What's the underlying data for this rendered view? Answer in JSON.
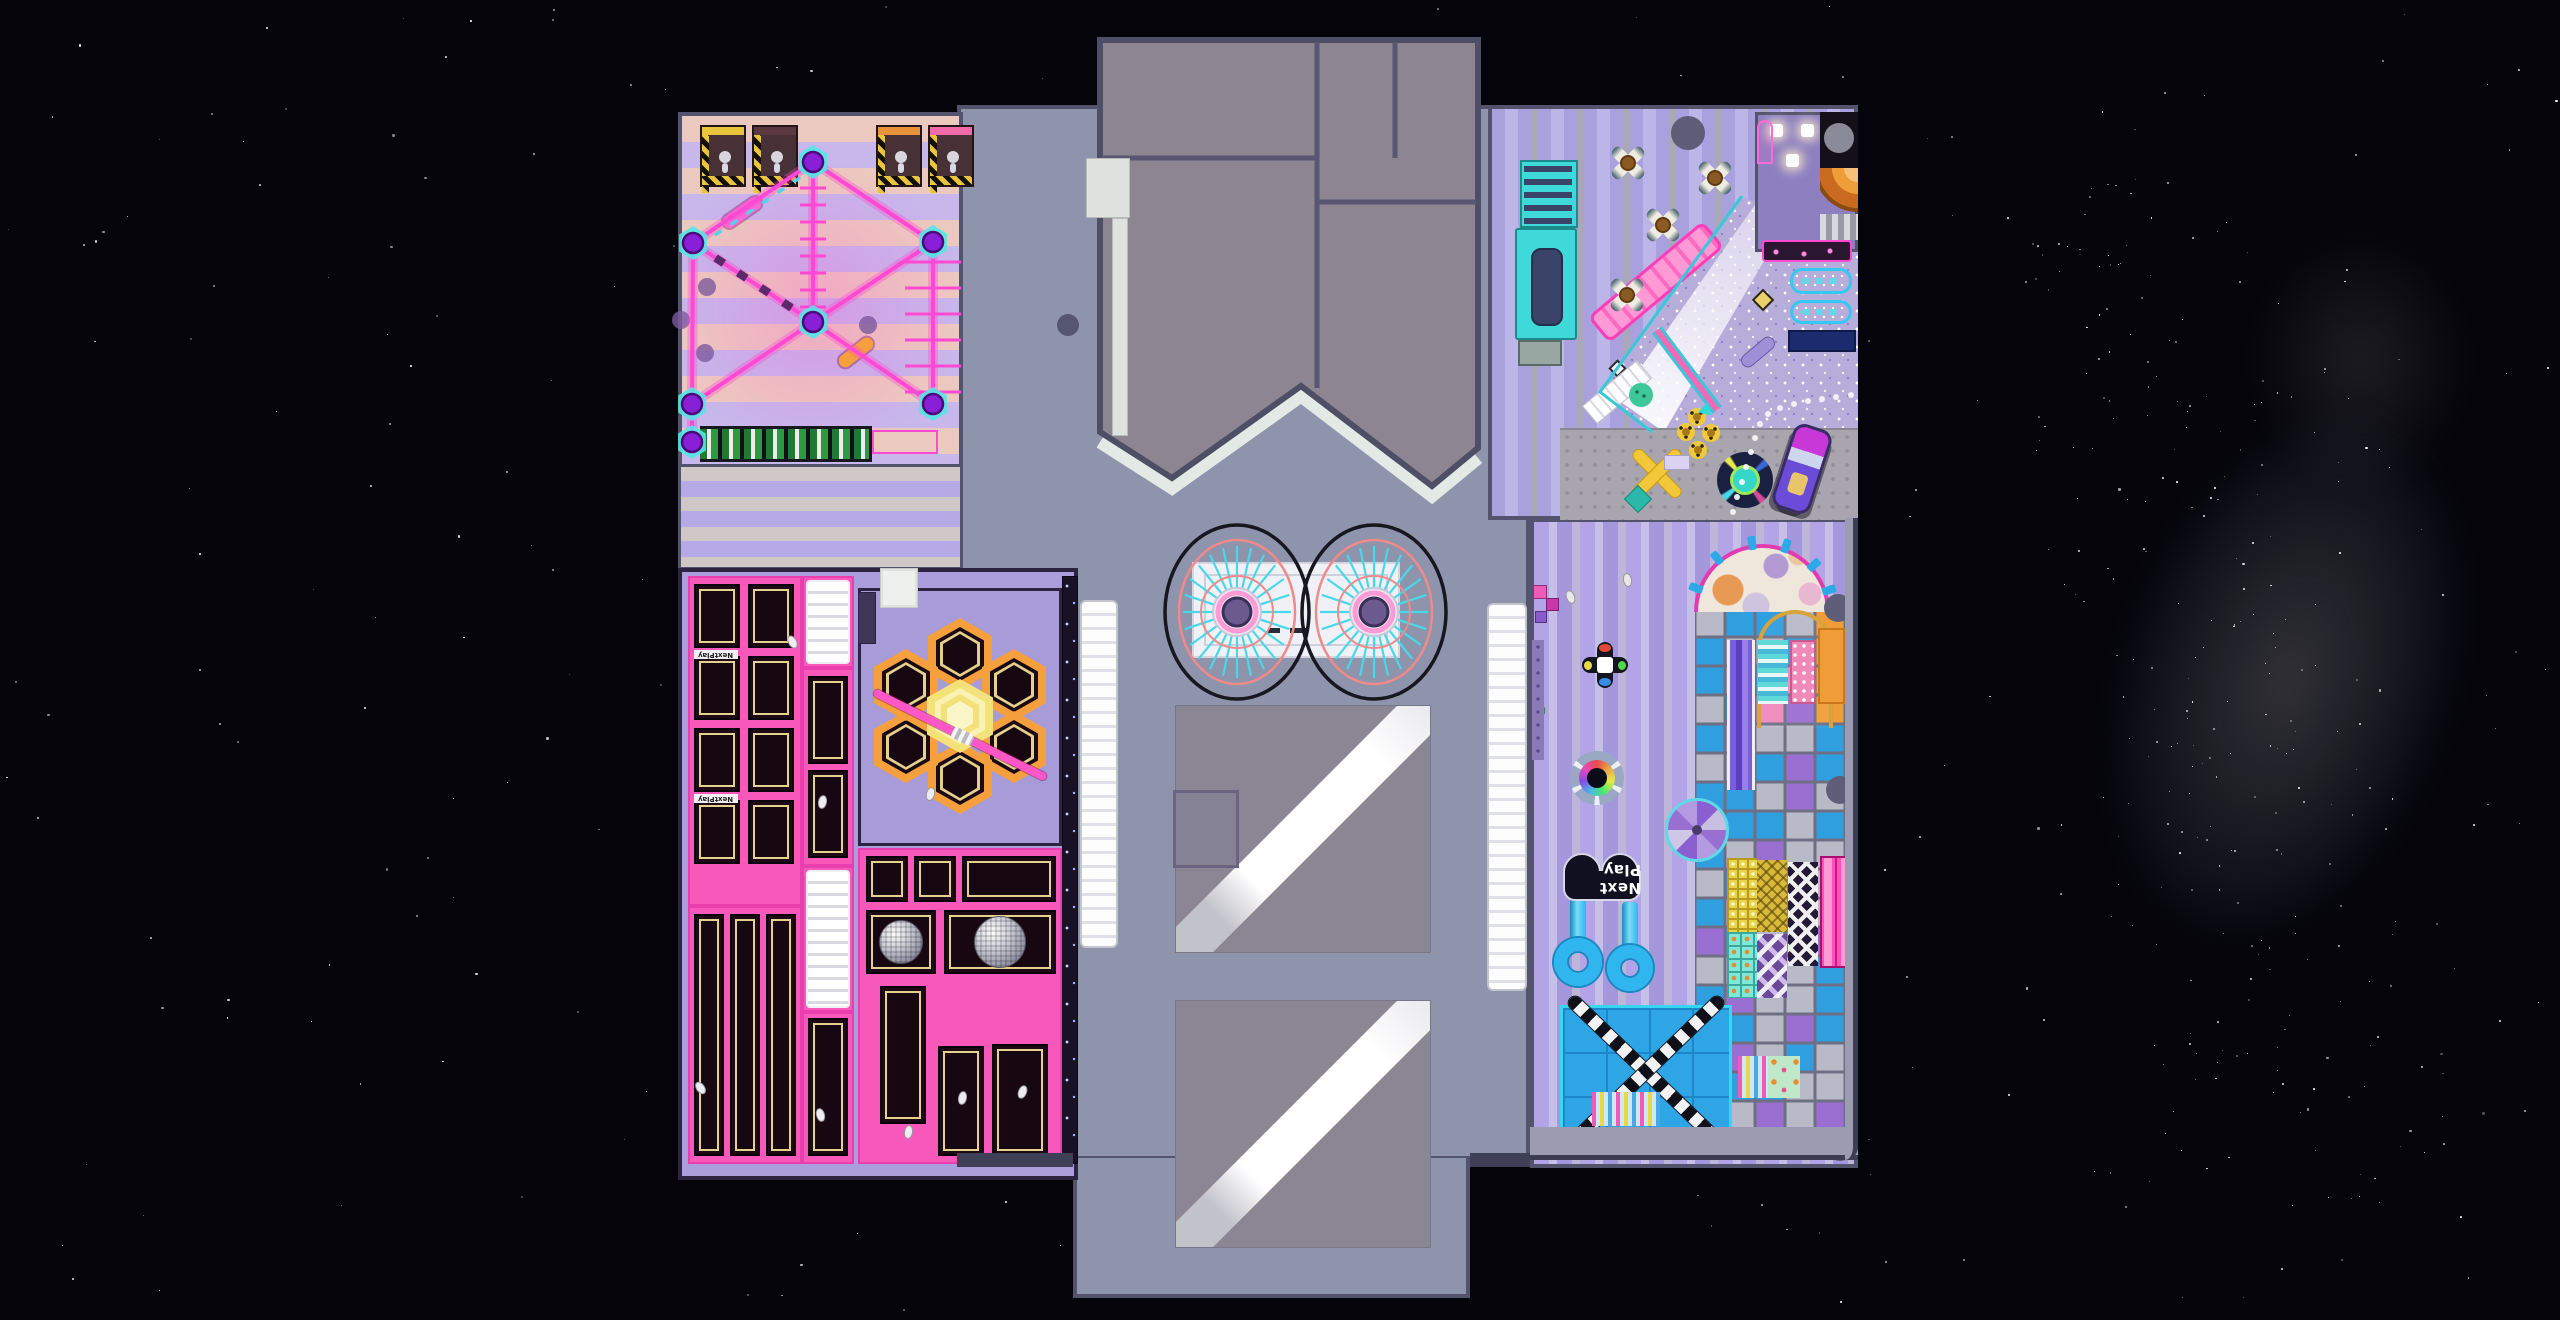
{
  "scene": {
    "width": 2560,
    "height": 1320,
    "background": "#04040a",
    "stars": 340,
    "milkyway_stars": 230,
    "seed": 7
  },
  "sign": {
    "label": "Next Play",
    "bed_label": "NextPlay"
  },
  "palette": {
    "wall": "#53536d",
    "wall_dark": "#2c2440",
    "center_floor": "#8d94ac",
    "roof": "#8d8692",
    "roof_seam": "#585672",
    "roof_trim": "#e3e9e5",
    "ropes_pink": "#ff49d2",
    "node_purple": "#8a1fd8",
    "pad_cyan": "#55e6e6",
    "stripe_peach": "#ecc9bf",
    "stripe_lavender": "#c7b7ea",
    "tramp_pink": "#f858ba",
    "bed_black": "#160711",
    "bed_gold": "#e5d18c",
    "tramp_floor": "#aa9fdc",
    "hex_orange": "#f5a03c",
    "hex_center_yellow": "#f3e27a",
    "cafe_stripe_a": "#a9a1de",
    "cafe_stripe_b": "#bcb5e8",
    "cafe_stripe_gray": "#a8a8b8",
    "kids_stripe_a": "#b2a4e6",
    "kids_stripe_b": "#c6bfe8",
    "glitter": "#b7addb",
    "carpet": "#a8a5af",
    "teal_desk": "#3fd9d9",
    "navy": "#2a3468",
    "cell_blue": "#2f9fe0",
    "cell_gray": "#b9bac8",
    "cell_purple": "#9a6fd2",
    "cell_orange": "#ef9d38",
    "cell_pink": "#f08ab8",
    "cell_cyan": "#5fd8d8",
    "tube_blue": "#2fb6ef",
    "xmat_blue": "#2ea6e6",
    "sign_bg": "#101020",
    "pillar": "#5e5e78"
  },
  "zones": [
    {
      "id": "center-floor",
      "x": 957,
      "y": 105,
      "w": 573,
      "h": 1055
    },
    {
      "id": "tongue",
      "x": 1073,
      "y": 1158,
      "w": 397,
      "h": 140
    },
    {
      "id": "ropes-course",
      "x": 678,
      "y": 112,
      "w": 285,
      "h": 356
    },
    {
      "id": "stripe-band",
      "x": 678,
      "y": 464,
      "w": 285,
      "h": 106
    },
    {
      "id": "trampoline-park",
      "x": 678,
      "y": 568,
      "w": 400,
      "h": 612
    },
    {
      "id": "cafe",
      "x": 1488,
      "y": 105,
      "w": 370,
      "h": 415
    },
    {
      "id": "kids-play",
      "x": 1530,
      "y": 518,
      "w": 328,
      "h": 650
    }
  ],
  "roof": {
    "outline": [
      [
        1100,
        40
      ],
      [
        1478,
        40
      ],
      [
        1478,
        448
      ],
      [
        1432,
        486
      ],
      [
        1301,
        386
      ],
      [
        1172,
        478
      ],
      [
        1100,
        432
      ]
    ],
    "trim": [
      [
        1100,
        442
      ],
      [
        1172,
        488
      ],
      [
        1301,
        396
      ],
      [
        1432,
        496
      ],
      [
        1478,
        458
      ]
    ],
    "seams": [
      [
        [
          1317,
          42
        ],
        [
          1317,
          388
        ]
      ],
      [
        [
          1395,
          42
        ],
        [
          1395,
          158
        ]
      ],
      [
        [
          1102,
          158
        ],
        [
          1317,
          158
        ]
      ],
      [
        [
          1317,
          202
        ],
        [
          1476,
          202
        ]
      ]
    ],
    "walk_rect": [
      1086,
      158,
      44,
      60
    ],
    "walk_strip": [
      1112,
      218,
      16,
      218
    ]
  },
  "ropes": {
    "nodes": [
      [
        813,
        162
      ],
      [
        693,
        243
      ],
      [
        933,
        242
      ],
      [
        813,
        322
      ],
      [
        692,
        404
      ],
      [
        933,
        404
      ],
      [
        692,
        442
      ]
    ],
    "edges": [
      [
        0,
        1
      ],
      [
        0,
        2
      ],
      [
        0,
        3
      ],
      [
        1,
        3
      ],
      [
        2,
        3
      ],
      [
        3,
        4
      ],
      [
        3,
        5
      ],
      [
        1,
        4
      ],
      [
        2,
        5
      ],
      [
        4,
        6
      ]
    ],
    "rungs": [
      {
        "x": 813,
        "y1": 188,
        "y2": 308,
        "len": 26,
        "step": 17
      },
      {
        "x": 933,
        "y1": 262,
        "y2": 394,
        "len": 56,
        "step": 26
      }
    ],
    "obstacles": [
      {
        "x": 742,
        "y": 212,
        "w": 44,
        "h": 13,
        "rot": -35,
        "color": "#ff6ad8"
      },
      {
        "x": 856,
        "y": 352,
        "w": 40,
        "h": 13,
        "rot": -38,
        "color": "#f5a03c"
      }
    ],
    "dots": [
      [
        707,
        287
      ],
      [
        681,
        320
      ],
      [
        705,
        353
      ],
      [
        868,
        325
      ]
    ],
    "ladder": [
      700,
      426,
      172,
      36
    ],
    "ladder_ext": [
      872,
      430,
      66,
      24
    ],
    "kiosks": [
      {
        "x": 700,
        "y": 125,
        "bar": "#e8c53a"
      },
      {
        "x": 752,
        "y": 125,
        "bar": "#5a3a40"
      },
      {
        "x": 876,
        "y": 125,
        "bar": "#e8923a"
      },
      {
        "x": 928,
        "y": 125,
        "bar": "#ef6aa8"
      }
    ]
  },
  "trampoline": {
    "blocks": [
      [
        688,
        576,
        114,
        330
      ],
      [
        802,
        576,
        52,
        92
      ],
      [
        802,
        668,
        52,
        198
      ],
      [
        802,
        866,
        52,
        146
      ],
      [
        688,
        906,
        114,
        258
      ],
      [
        802,
        1012,
        52,
        152
      ],
      [
        858,
        848,
        204,
        316
      ]
    ],
    "beds": [
      [
        694,
        584,
        46,
        64
      ],
      [
        748,
        584,
        46,
        64
      ],
      [
        694,
        656,
        46,
        64
      ],
      [
        748,
        656,
        46,
        64
      ],
      [
        694,
        728,
        46,
        64
      ],
      [
        748,
        728,
        46,
        64
      ],
      [
        694,
        800,
        46,
        64
      ],
      [
        748,
        800,
        46,
        64
      ],
      [
        808,
        676,
        40,
        88
      ],
      [
        808,
        770,
        40,
        88
      ],
      [
        694,
        914,
        30,
        242
      ],
      [
        730,
        914,
        30,
        242
      ],
      [
        766,
        914,
        30,
        242
      ],
      [
        808,
        1018,
        40,
        138
      ],
      [
        866,
        856,
        42,
        46
      ],
      [
        914,
        856,
        42,
        46
      ],
      [
        962,
        856,
        94,
        46
      ],
      [
        866,
        910,
        70,
        64
      ],
      [
        944,
        910,
        112,
        64
      ],
      [
        880,
        986,
        46,
        138
      ],
      [
        938,
        1046,
        46,
        110
      ],
      [
        992,
        1044,
        56,
        112
      ]
    ],
    "airbags": [
      [
        806,
        580,
        44,
        84
      ],
      [
        806,
        870,
        44,
        138
      ]
    ],
    "label_strips": [
      [
        694,
        650,
        44,
        9
      ],
      [
        694,
        794,
        44,
        9
      ]
    ],
    "disco_balls": [
      [
        901,
        942,
        22
      ],
      [
        1000,
        942,
        26
      ]
    ],
    "hex_zone": [
      858,
      588,
      204,
      258
    ],
    "hex_ring": [
      [
        960,
        654
      ],
      [
        1014,
        685
      ],
      [
        1014,
        747
      ],
      [
        960,
        778
      ],
      [
        906,
        747
      ],
      [
        906,
        685
      ]
    ],
    "hex_center": [
      960,
      716
    ],
    "beam": {
      "x1": 874,
      "y1": 692,
      "x2": 1046,
      "y2": 778
    },
    "stair_block": [
      880,
      568,
      38,
      40
    ],
    "dark_block": [
      858,
      592,
      18,
      52
    ],
    "wall_strip": [
      1062,
      576,
      16,
      588
    ],
    "figures": [
      [
        792,
        642
      ],
      [
        822,
        802
      ],
      [
        700,
        1088
      ],
      [
        908,
        1132
      ],
      [
        962,
        1098
      ],
      [
        1022,
        1092
      ],
      [
        930,
        794
      ],
      [
        820,
        1115
      ]
    ]
  },
  "cafe": {
    "tables": [
      [
        1628,
        163
      ],
      [
        1715,
        178
      ],
      [
        1663,
        225
      ],
      [
        1627,
        295
      ]
    ],
    "desk": {
      "shelves": [
        1520,
        160,
        58,
        68
      ],
      "counter": [
        1515,
        228,
        62,
        112
      ],
      "inner": [
        1531,
        248,
        32,
        78
      ],
      "box": [
        1518,
        340,
        44,
        26
      ]
    },
    "pillars": [
      [
        1688,
        133,
        17
      ]
    ],
    "corner_room": {
      "rect": [
        1755,
        112,
        103,
        140
      ],
      "tables": [
        [
          1770,
          124
        ],
        [
          1801,
          124
        ],
        [
          1786,
          154
        ]
      ],
      "arch": [
        1757,
        120,
        16,
        44
      ],
      "black": [
        1820,
        112,
        38,
        56
      ],
      "circle": [
        1839,
        138,
        15
      ],
      "quarter": [
        1820,
        168,
        38,
        44
      ],
      "silver": [
        1820,
        214,
        38,
        26
      ],
      "neon": [
        1762,
        240,
        90,
        22
      ]
    },
    "glitter_poly": [
      [
        1742,
        196
      ],
      [
        1858,
        252
      ],
      [
        1858,
        430
      ],
      [
        1652,
        432
      ],
      [
        1600,
        392
      ]
    ],
    "beam_poly": [
      [
        1618,
        400
      ],
      [
        1664,
        432
      ],
      [
        1788,
        220
      ],
      [
        1757,
        202
      ]
    ],
    "pink_track": {
      "x": 1656,
      "y": 282,
      "w": 150,
      "h": 34,
      "rot": -40
    },
    "stairs": {
      "x": 1617,
      "y": 392,
      "w": 72,
      "h": 24,
      "rot": -40
    },
    "pink_path": {
      "x": 1687,
      "y": 370,
      "w": 100,
      "h": 12,
      "rot": 53
    },
    "neon_panels": [
      [
        1790,
        268,
        62,
        26
      ],
      [
        1790,
        300,
        62,
        24
      ]
    ],
    "navy_bar": [
      1788,
      330,
      68,
      22
    ],
    "gold_diamond": [
      1763,
      300,
      16
    ],
    "white_diamond": [
      1617,
      368,
      13
    ],
    "capsule": [
      1758,
      352,
      40,
      14,
      -40
    ],
    "carpet": [
      1560,
      428,
      298,
      92
    ],
    "flowers": [
      [
        1697,
        417
      ],
      [
        1686,
        432
      ],
      [
        1711,
        433
      ],
      [
        1698,
        450
      ]
    ],
    "bench": {
      "center": [
        1657,
        473
      ],
      "card": [
        1664,
        455,
        26,
        15
      ],
      "teal": [
        1628,
        489,
        20,
        20
      ]
    },
    "ride": [
      1745,
      480
    ],
    "car": {
      "x": 1782,
      "y": 425,
      "w": 40,
      "h": 88,
      "rot": 18
    },
    "dots": [
      [
        1733,
        512
      ],
      [
        1737,
        497
      ],
      [
        1742,
        482
      ],
      [
        1746,
        467
      ],
      [
        1751,
        452
      ],
      [
        1755,
        438
      ],
      [
        1760,
        424
      ],
      [
        1768,
        414
      ],
      [
        1780,
        408
      ],
      [
        1794,
        404
      ],
      [
        1808,
        401
      ],
      [
        1822,
        399
      ],
      [
        1836,
        397
      ],
      [
        1851,
        395
      ]
    ],
    "green_mat": [
      1641,
      395,
      12
    ],
    "teal_tri": [
      1706,
      408
    ]
  },
  "kids": {
    "structure": {
      "x": 1695,
      "y": 608,
      "cols": 5,
      "cell_w": 30,
      "cell_h": 29,
      "map": [
        "gbbgo",
        "bggbo",
        "bgbko",
        "gbkpo",
        "bgggb",
        "ggbpb",
        "bbgpg",
        "gbbgb",
        "bgpgg",
        "gbbpg",
        "bggbg",
        "pbgbp",
        "ggbgb",
        "bpggb",
        "gbgpb",
        "ppgbg",
        "gbbgg",
        "pgpgp"
      ]
    },
    "dome": {
      "cx": 1762,
      "cy": 612,
      "r": 68
    },
    "slide_stripes": [
      1727,
      640,
      28,
      150
    ],
    "gold_arch": [
      1757,
      610,
      76,
      118
    ],
    "panels": [
      {
        "r": [
          1818,
          628,
          27,
          76
        ],
        "t": "orange"
      },
      {
        "r": [
          1790,
          640,
          26,
          64
        ],
        "t": "pinkdot"
      },
      {
        "r": [
          1758,
          640,
          30,
          64
        ],
        "t": "tealstripe"
      },
      {
        "r": [
          1727,
          858,
          30,
          74
        ],
        "t": "ygrid"
      },
      {
        "r": [
          1757,
          860,
          30,
          72
        ],
        "t": "gnet"
      },
      {
        "r": [
          1788,
          862,
          30,
          104
        ],
        "t": "chevron"
      },
      {
        "r": [
          1727,
          932,
          30,
          66
        ],
        "t": "tgrid"
      },
      {
        "r": [
          1757,
          934,
          30,
          64
        ],
        "t": "diam"
      },
      {
        "r": [
          1820,
          856,
          30,
          112
        ],
        "t": "pinklanes"
      },
      {
        "r": [
          1738,
          1056,
          30,
          42
        ],
        "t": "candy"
      },
      {
        "r": [
          1768,
          1056,
          32,
          42
        ],
        "t": "mint"
      }
    ],
    "spiral": [
      1697,
      830,
      32
    ],
    "tubes": {
      "loops": [
        [
          1578,
          962,
          24
        ],
        [
          1630,
          968,
          23
        ]
      ],
      "stems": [
        [
          1570,
          898,
          16,
          46
        ],
        [
          1622,
          902,
          16,
          48
        ]
      ]
    },
    "sign_pos": [
      1563,
      853,
      78,
      50
    ],
    "xmat": {
      "rect": [
        1560,
        1005,
        172,
        133
      ],
      "beam_len": 210,
      "beam_w": 13,
      "angles": [
        44,
        -44
      ]
    },
    "candy_strip": [
      1592,
      1092,
      68,
      34
    ],
    "cubes": [
      [
        1533,
        585,
        14,
        "#f05ab8"
      ],
      [
        1546,
        598,
        13,
        "#c838a8"
      ],
      [
        1535,
        611,
        12,
        "#8a5acb"
      ]
    ],
    "dpad": [
      1605,
      665
    ],
    "spinner": [
      1597,
      778,
      27
    ],
    "figures": [
      [
        1540,
        712,
        "#4ac86a"
      ],
      [
        1570,
        597,
        "#e8e8e8"
      ],
      [
        1627,
        580,
        "#e8e8e8"
      ]
    ],
    "pillars": [
      [
        1838,
        608,
        14
      ],
      [
        1840,
        790,
        14
      ],
      [
        1697,
        1143,
        16
      ],
      [
        1840,
        1145,
        16
      ]
    ],
    "bands": {
      "right": [
        1845,
        518,
        13,
        642
      ],
      "bottom": [
        1530,
        1127,
        328,
        33
      ]
    },
    "purple_panel": [
      1532,
      640,
      12,
      120
    ]
  },
  "center": {
    "circles": [
      [
        1237,
        612
      ],
      [
        1374,
        612
      ]
    ],
    "platform": [
      1192,
      562,
      208,
      96
    ],
    "platform_marks": [
      [
        1268,
        628,
        12,
        5
      ],
      [
        1290,
        628,
        16,
        5
      ]
    ],
    "ramps": [
      [
        1175,
        705,
        256,
        248
      ],
      [
        1175,
        1000,
        256,
        248
      ]
    ],
    "small_square": [
      1173,
      790,
      66,
      78
    ],
    "strips": [
      [
        1080,
        600,
        38,
        348
      ],
      [
        1487,
        603,
        40,
        388
      ]
    ],
    "pillars": [
      [
        1068,
        325,
        11
      ]
    ],
    "walls": [
      [
        957,
        1153,
        116,
        14
      ],
      [
        1470,
        1153,
        60,
        14
      ]
    ]
  }
}
